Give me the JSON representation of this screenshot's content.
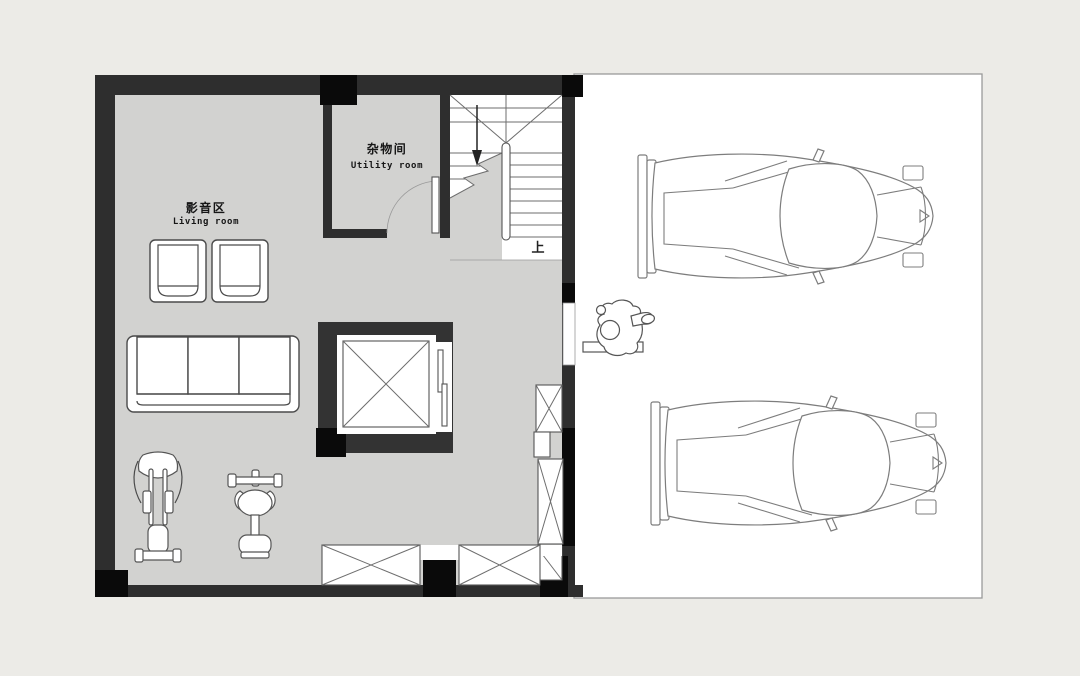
{
  "labels": {
    "living_zh": "影音区",
    "living_en": "Living room",
    "utility_zh": "杂物间",
    "utility_en": "Utility room",
    "stairs_up": "上"
  },
  "colors": {
    "background": "#ECEBE7",
    "floor_gray": "#D2D2D0",
    "wall_dark": "#2E2E2E",
    "column_black": "#0A0A0A",
    "garage_floor": "#FFFFFF",
    "drawing_line": "#6E6E6E"
  },
  "objects": [
    "living-media-room",
    "utility-room",
    "staircase-up",
    "elevator-shaft",
    "three-seat-sofa",
    "armchair",
    "armchair",
    "elliptical-trainer",
    "weight-bench",
    "storage-shaft-boxes",
    "low-cabinet-windows",
    "garage",
    "sports-car-top-view",
    "sports-car-top-view",
    "person-figure",
    "door-step"
  ]
}
